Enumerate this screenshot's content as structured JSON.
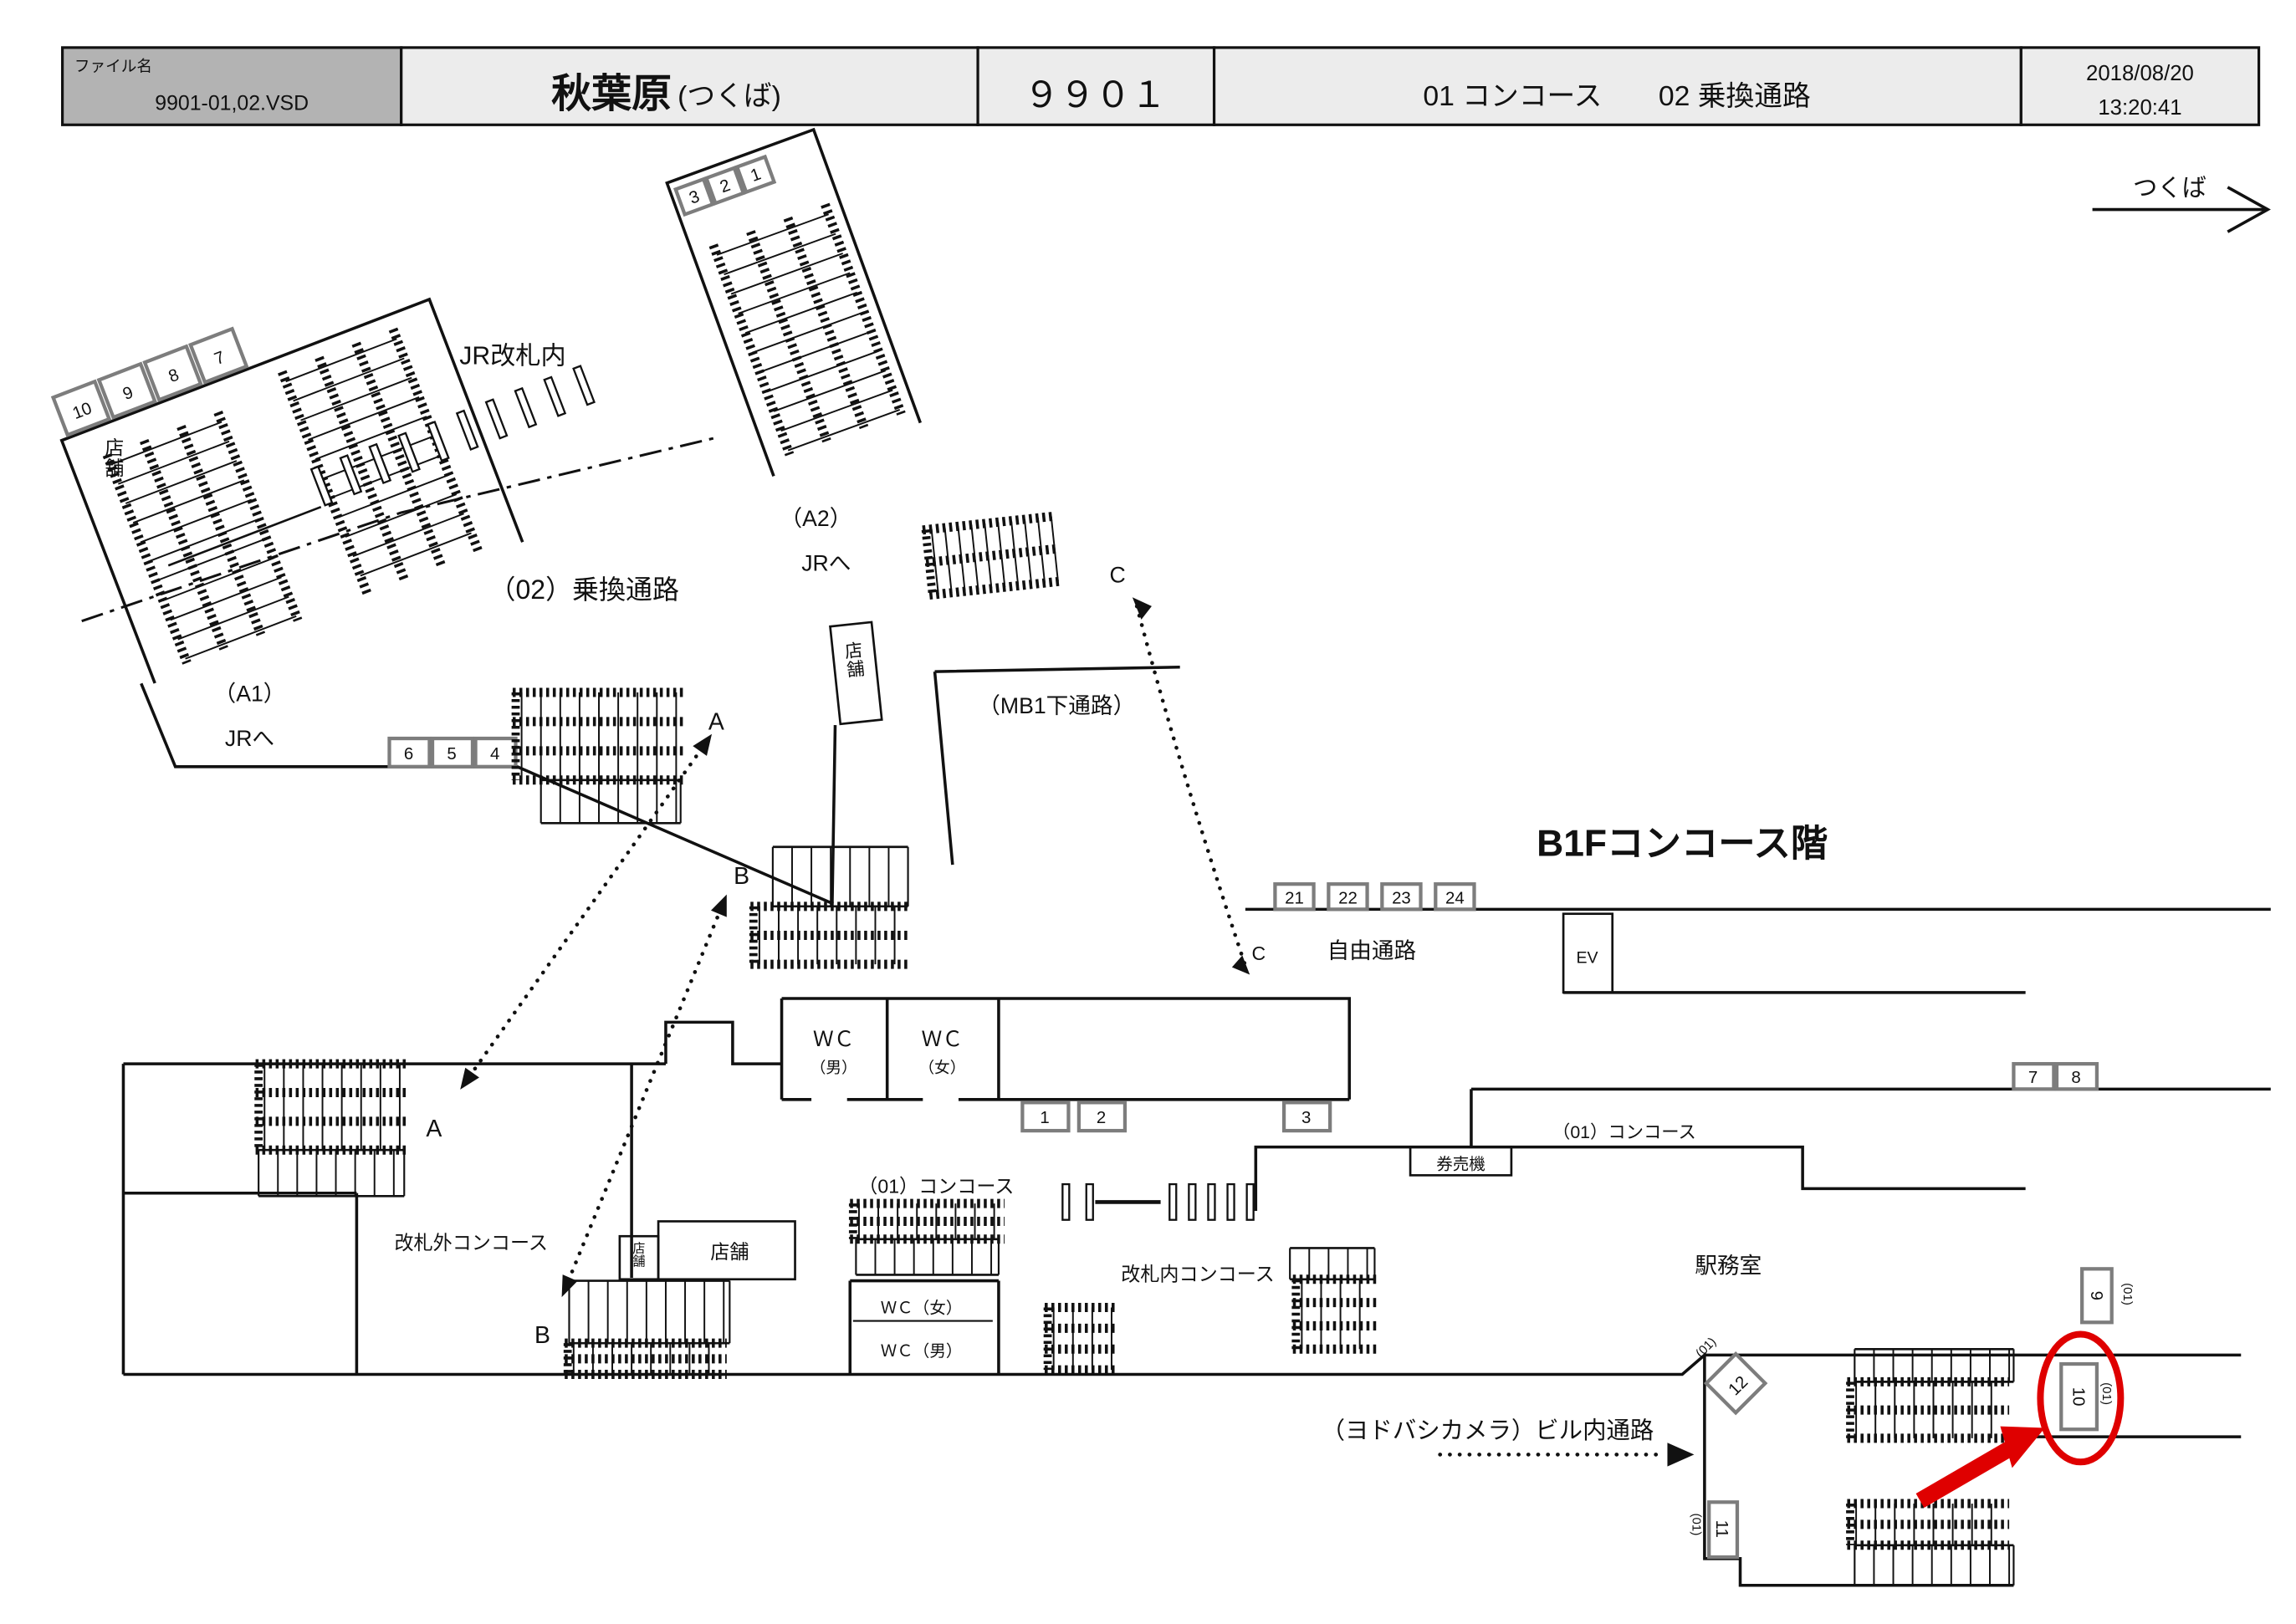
{
  "header": {
    "file_label": "ファイル名",
    "file_name": "9901-01,02.VSD",
    "station": "秋葉原",
    "station_sub": "(つくば)",
    "code": "９９０１",
    "areas": "01 コンコース　　02 乗換通路",
    "date": "2018/08/20",
    "time": "13:20:41"
  },
  "direction": {
    "label": "つくば"
  },
  "upper": {
    "jr_inside": "JR改札内",
    "corridor02": "（02）乗換通路",
    "a1": "（A1）",
    "a1_dest": "JRへ",
    "a2": "（A2）",
    "a2_dest": "JRへ",
    "mb1": "（MB1下通路）",
    "shop": "店舗",
    "strip_left": [
      "10",
      "9",
      "8",
      "7"
    ],
    "boxes_654": [
      "6",
      "5",
      "4"
    ],
    "strip_right": [
      "3",
      "2",
      "1"
    ],
    "pt_a": "A",
    "pt_b": "B",
    "pt_c": "C"
  },
  "lower": {
    "title": "B1Fコンコース階",
    "boxes_2124": [
      "21",
      "22",
      "23",
      "24"
    ],
    "ev": "EV",
    "pt_c": "C",
    "free_passage": "自由通路",
    "wc": "ＷＣ",
    "wc_m": "（男）",
    "wc_f": "（女）",
    "boxes_123": [
      "1",
      "2",
      "3"
    ],
    "concourse_left": "（01）コンコース",
    "outside_gate": "改札外コンコース",
    "pt_a": "A",
    "pt_b": "B",
    "shop": "店舗",
    "wc_f_line": "ＷＣ（女）",
    "wc_m_line": "ＷＣ（男）",
    "inside_gate": "改札内コンコース",
    "ticket_machine": "券売機",
    "office": "駅務室",
    "concourse_right": "（01）コンコース",
    "boxes_78": [
      "7",
      "8"
    ],
    "box_9": "9",
    "box_10": "10",
    "box_11": "11",
    "box_12": "12",
    "tag_01": "(01)",
    "yodobashi": "（ヨドバシカメラ）ビル内通路"
  }
}
